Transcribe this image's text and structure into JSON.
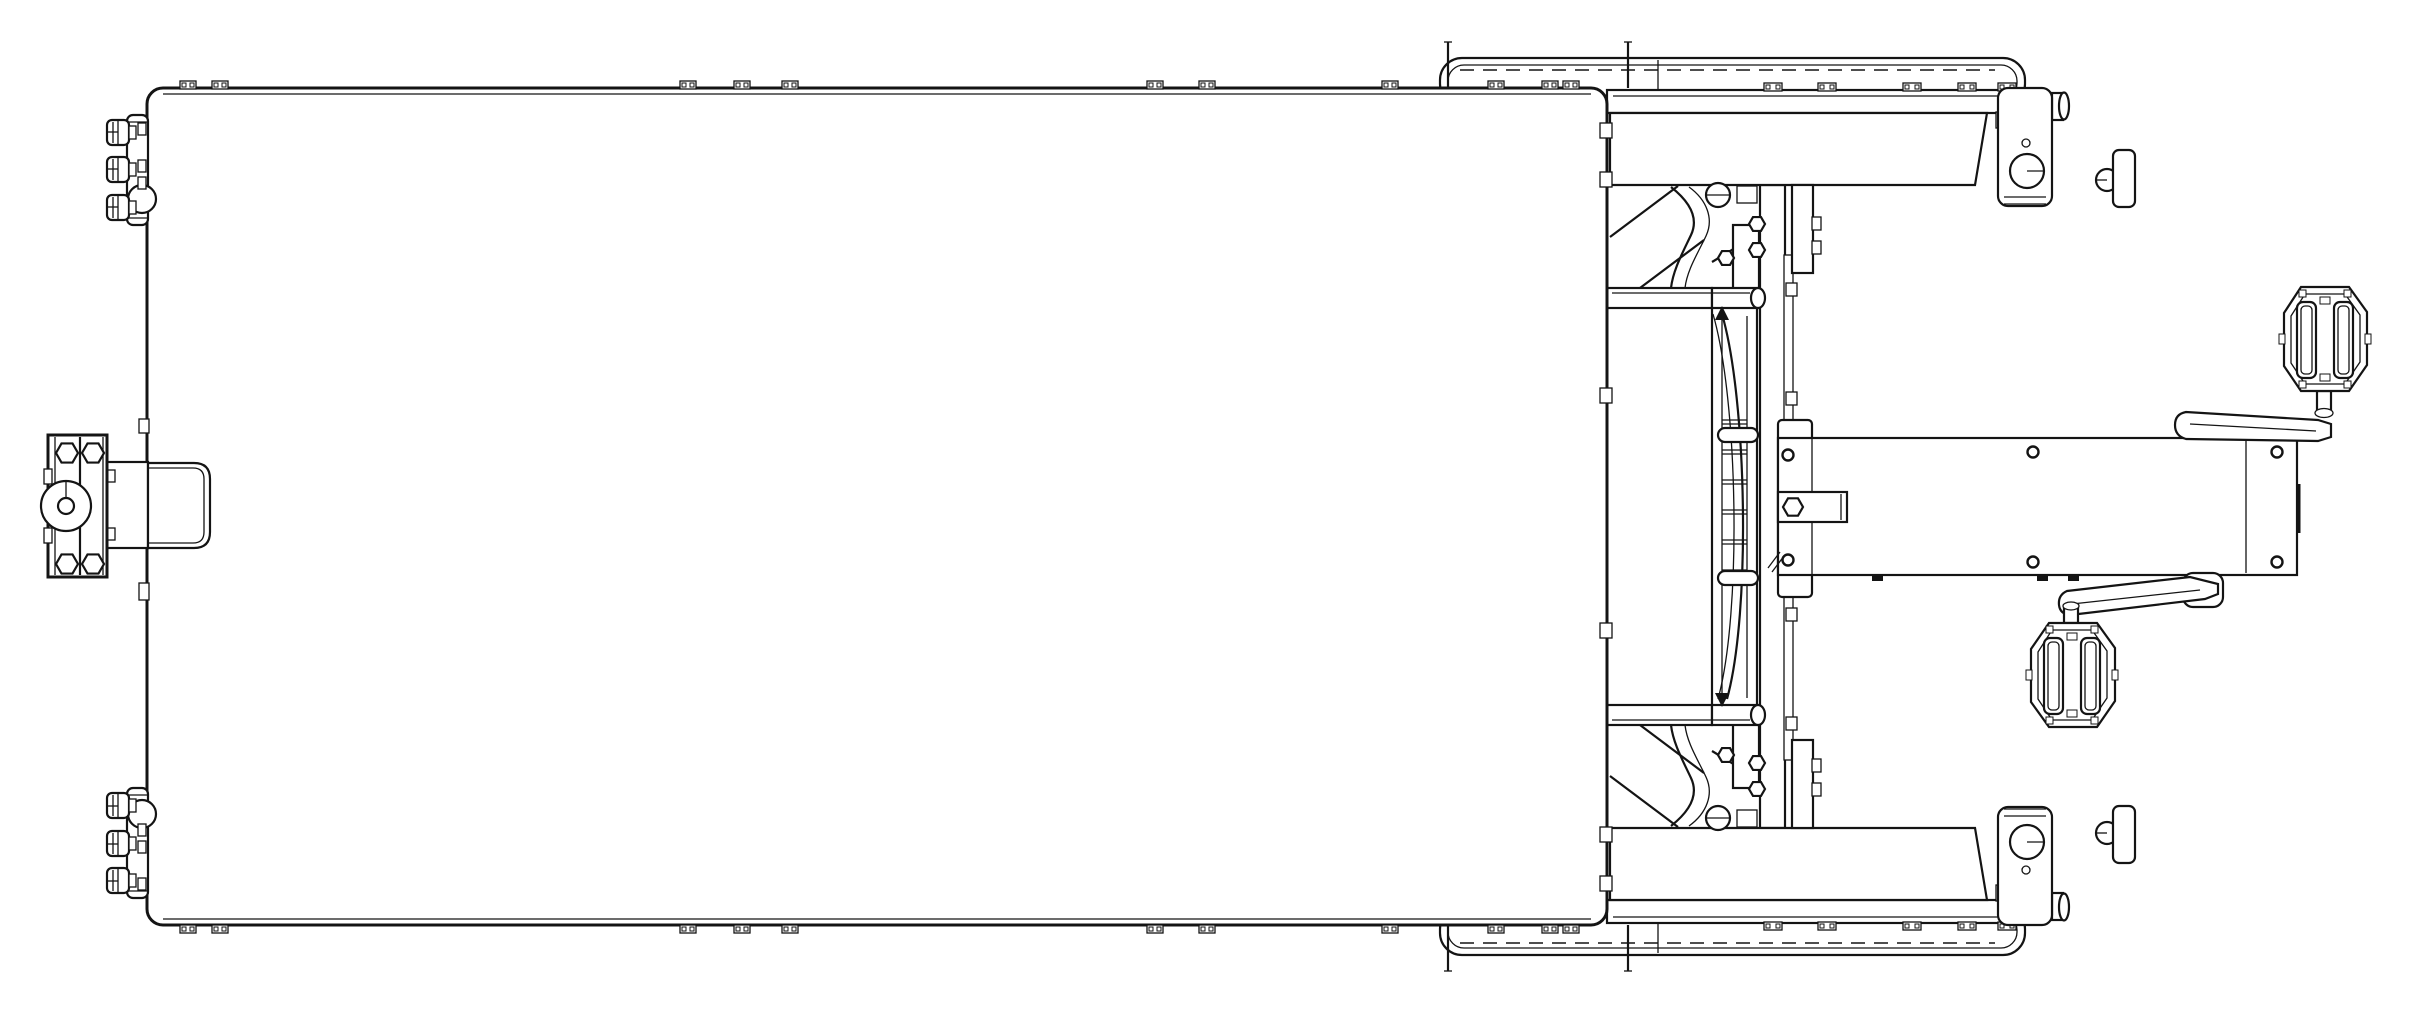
{
  "meta": {
    "title": "CAD technical drawing - top (plan) view of a pedal-powered cargo trailer",
    "view": "top view, monochrome line drawing",
    "background_color": "#ffffff",
    "line_color": "#141414",
    "canvas": {
      "width": 2409,
      "height": 1020
    }
  },
  "components": [
    {
      "name": "cargo-bed",
      "desc": "large flat rectangular cargo bed cover with edge tabs"
    },
    {
      "name": "hitch-assembly",
      "desc": "left tow hitch: bolted plate, coupler disc with center hole, drawbar, receiver socket"
    },
    {
      "name": "roller-cluster-top",
      "desc": "three cylindrical fittings on upper left edge"
    },
    {
      "name": "roller-cluster-bottom",
      "desc": "three cylindrical fittings on lower left edge"
    },
    {
      "name": "wheel-fender-top",
      "desc": "upper wheel with fender, dashed tread line"
    },
    {
      "name": "wheel-fender-bottom",
      "desc": "lower wheel with fender, dashed tread line"
    },
    {
      "name": "hub-bracket-top",
      "desc": "upper axle hub bracket with bearing circle and axle stub"
    },
    {
      "name": "hub-bracket-bottom",
      "desc": "lower axle hub bracket with bearing circle and axle stub"
    },
    {
      "name": "frame-bench",
      "desc": "transverse frame members between wheels"
    },
    {
      "name": "seat-spring-assembly",
      "desc": "central leaf-spring / ladder assembly with clamps and arrows"
    },
    {
      "name": "boom-arm",
      "desc": "rear boom beam with six bolt holes and hitch tongue"
    },
    {
      "name": "crank-upper",
      "desc": "upper crank arm"
    },
    {
      "name": "crank-lower",
      "desc": "lower crank arm"
    },
    {
      "name": "pedal-upper",
      "desc": "upper bicycle platform pedal"
    },
    {
      "name": "pedal-lower",
      "desc": "lower bicycle platform pedal"
    }
  ],
  "geometry": {
    "box": {
      "x": 147,
      "y": 88,
      "w": 1460,
      "h": 837,
      "corner_radius": 16
    },
    "box_tabs_x": [
      188,
      220,
      688,
      742,
      790,
      1155,
      1207,
      1390,
      1496,
      1550,
      1571
    ],
    "rail_tabs_x": [
      1773,
      1827,
      1912,
      1967,
      2007
    ],
    "boom_holes": [
      [
        1788,
        455
      ],
      [
        1788,
        560
      ],
      [
        2033,
        452
      ],
      [
        2033,
        562
      ],
      [
        2277,
        452
      ],
      [
        2277,
        562
      ]
    ],
    "boom_bottom_tabs_x": [
      1872,
      2037,
      2068
    ],
    "hitch_bolts": [
      [
        67,
        453,
        11
      ],
      [
        93,
        453,
        11
      ],
      [
        67,
        564,
        11
      ],
      [
        93,
        564,
        11
      ]
    ],
    "tongue_bolt": [
      [
        1793,
        507,
        10
      ]
    ],
    "gusset_bolts": [
      [
        1757,
        224,
        8
      ],
      [
        1757,
        250,
        8
      ],
      [
        1726,
        258,
        8
      ]
    ],
    "spring_rungs_y": [
      420,
      450,
      480,
      510,
      540,
      570
    ],
    "rollers_y": [
      120,
      157,
      195
    ],
    "roller_clips_y": [
      123,
      160,
      177
    ],
    "right_edge_clips_y": [
      123,
      172,
      388,
      623,
      827,
      876
    ],
    "left_edge_clips_y": [
      419,
      583
    ],
    "mirror_axis_y": 506.5
  }
}
